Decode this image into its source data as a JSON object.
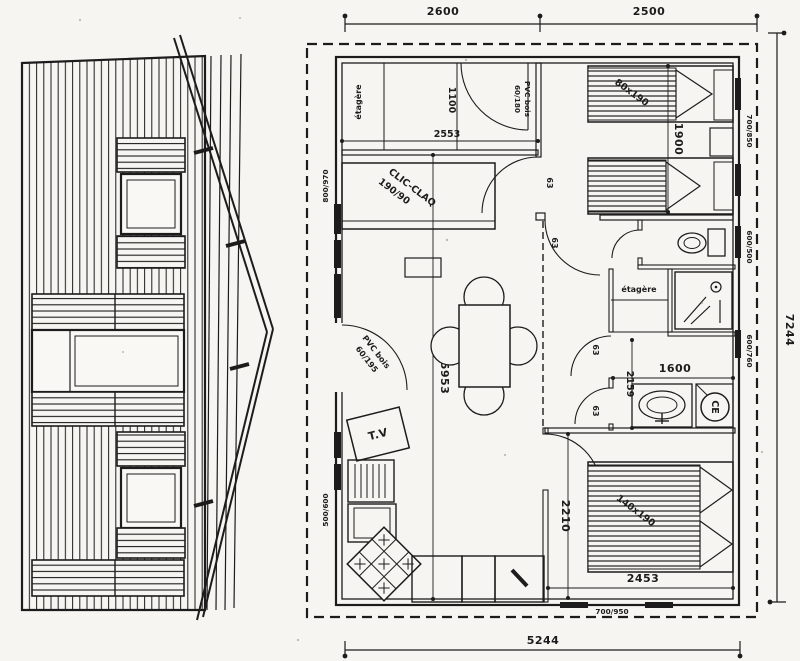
{
  "palette": {
    "paper": "#f6f5f1",
    "ink": "#1c1c1c"
  },
  "overall_dims": {
    "top_left": "2600",
    "top_right": "2500",
    "right_side": "7244",
    "bottom": "5244"
  },
  "interior_dims": {
    "closet_width": "2553",
    "closet_depth": "1100",
    "bedroom1_beds": "1900",
    "living_length": "5953",
    "hall_length": "2159",
    "bathroom_width": "1600",
    "bedroom2_length": "2210",
    "bedroom2_width": "2453"
  },
  "window_sizes": {
    "left_top": "800/970",
    "left_bottom": "500/600",
    "right_bedroom1": "700/850",
    "right_wc": "600/500",
    "right_bathroom": "600/760",
    "bottom_bedroom2": "700/950"
  },
  "door_widths": {
    "hall": "63",
    "bedroom1": "63",
    "shower": "63",
    "bathroom": "63"
  },
  "labels": {
    "closet_shelf": "étagère",
    "hall_shelf": "étagère",
    "sofa_bed": "CLIC-CLAQ",
    "sofa_bed_size": "190/90",
    "interior_door_material": "PVC bois",
    "interior_door_size": "60/180",
    "entry_door_material": "PVC bois",
    "entry_door_size": "60/195",
    "tv": "T.V",
    "single_bed_size": "80x190",
    "double_bed_size": "140x190",
    "water_heater": "CE"
  }
}
